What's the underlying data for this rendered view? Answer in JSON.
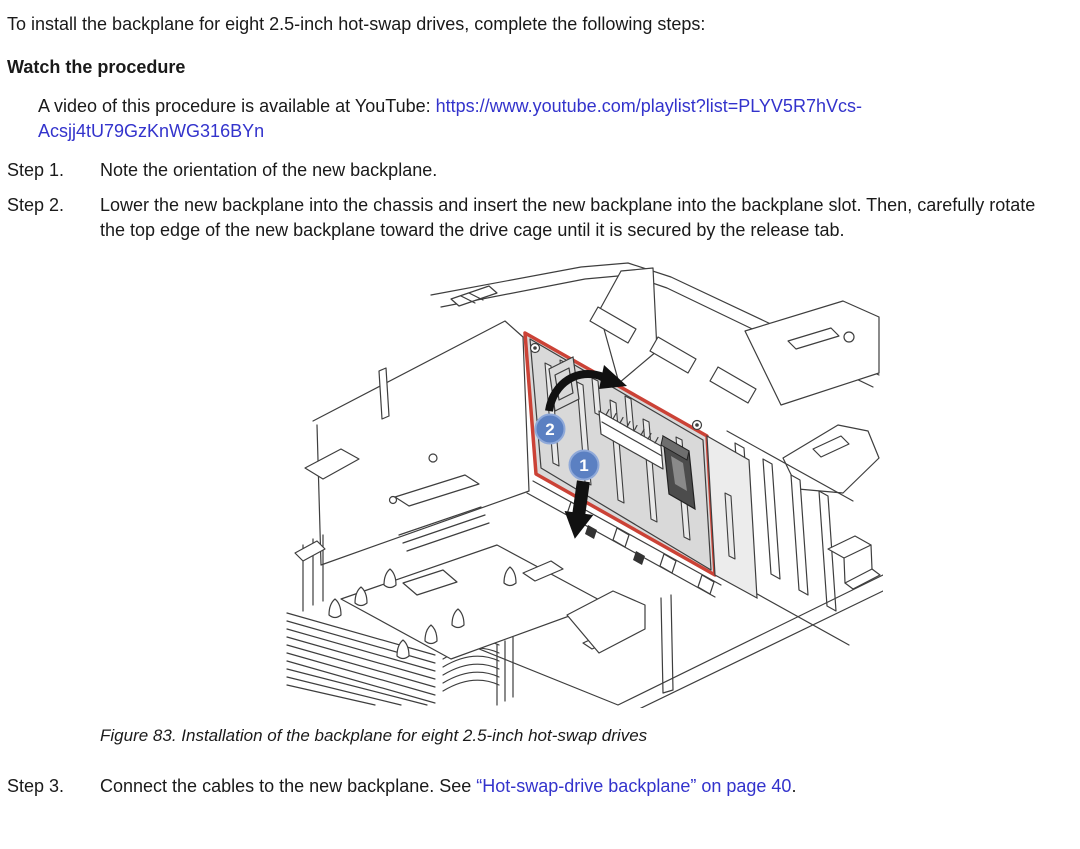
{
  "document": {
    "intro": "To install the backplane for eight 2.5-inch hot-swap drives, complete the following steps:",
    "watch_heading": "Watch the procedure",
    "video": {
      "prefix": "A video of this procedure is available at YouTube: ",
      "url": "https://www.youtube.com/playlist?list=PLYV5R7hVcs-Acsjj4tU79GzKnWG316BYn"
    },
    "steps": [
      {
        "label": "Step 1.",
        "text": "Note the orientation of the new backplane."
      },
      {
        "label": "Step 2.",
        "text": "Lower the new backplane into the chassis and insert the new backplane into the backplane slot. Then, carefully rotate the top edge of the new backplane toward the drive cage until it is secured by the release tab."
      },
      {
        "label": "Step 3.",
        "text_before_link": "Connect the cables to the new backplane. See ",
        "link_text": "“Hot-swap-drive backplane” on page 40",
        "text_after_link": "."
      }
    ],
    "figure": {
      "caption": "Figure 83. Installation of the backplane for eight 2.5-inch hot-swap drives",
      "callouts": [
        "1",
        "2"
      ]
    },
    "colors": {
      "link_blue": "#3333CC",
      "highlight_red": "#CB4236",
      "callout_blue": "#5B80C2",
      "board_gray": "#D9D9D9",
      "line_art": "#3E3E3E"
    }
  }
}
